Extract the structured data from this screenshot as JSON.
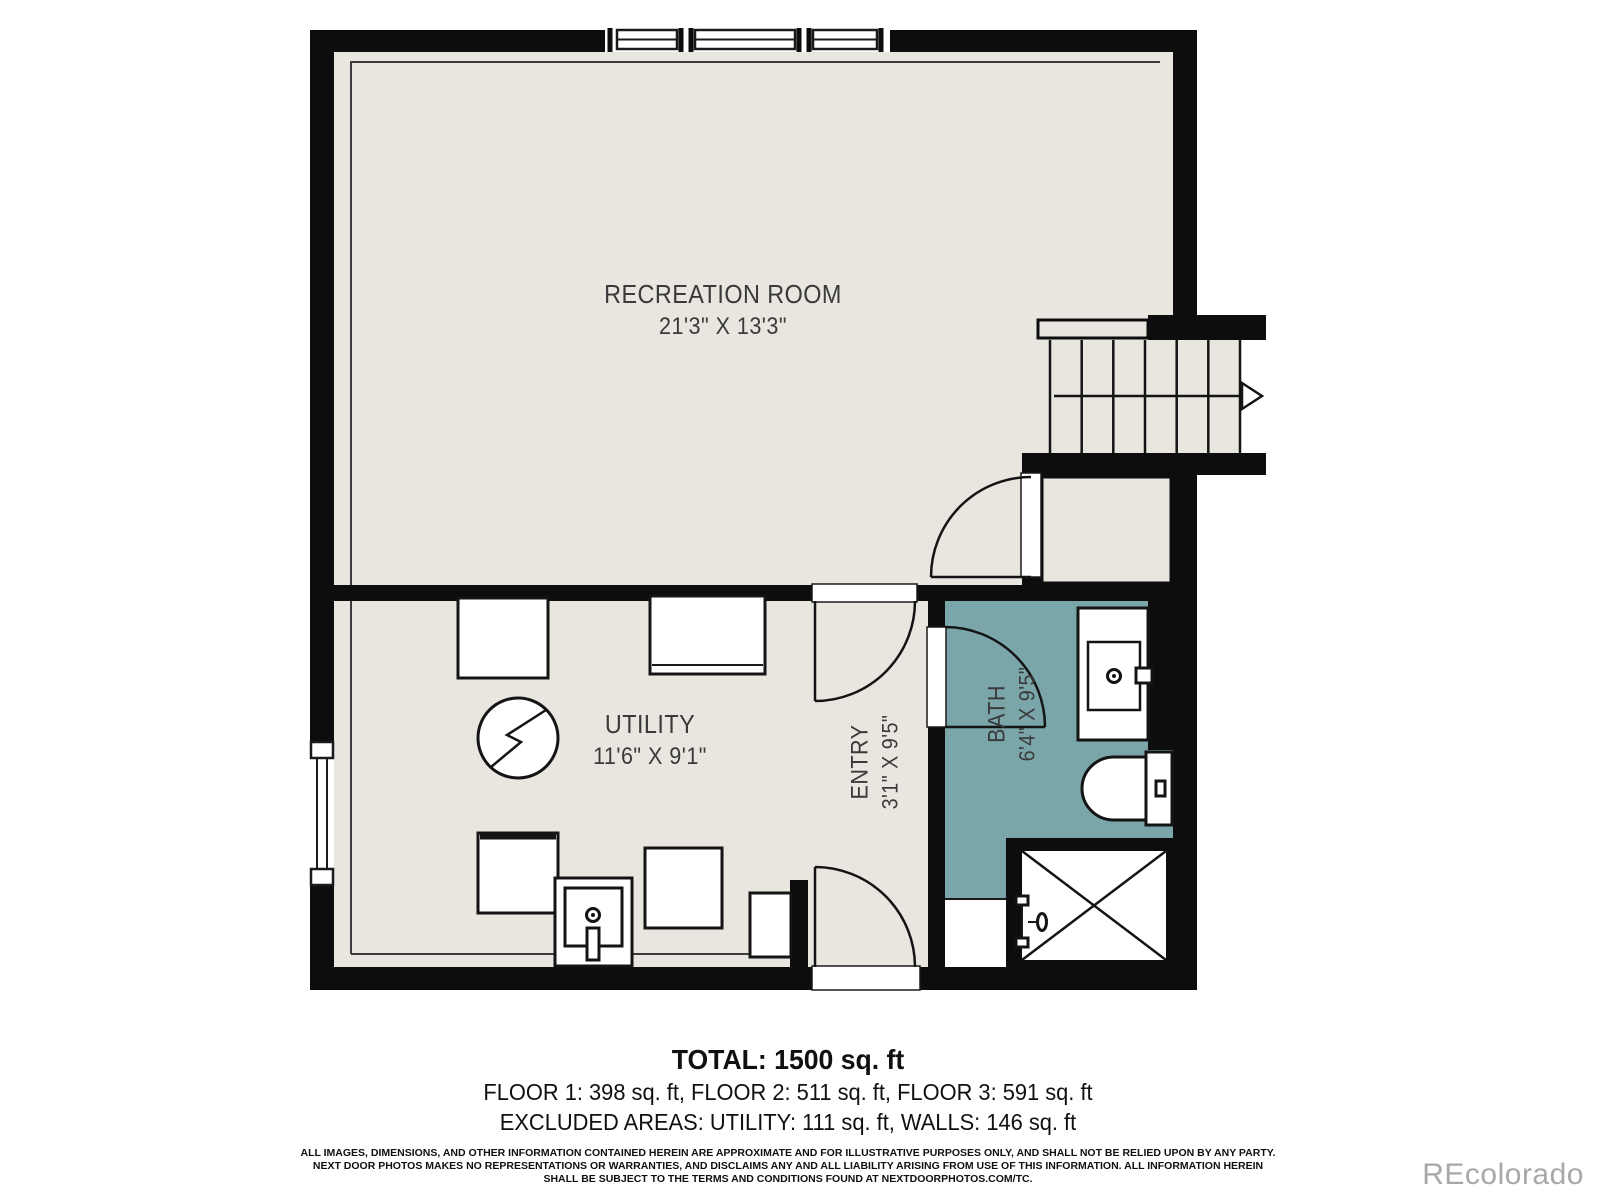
{
  "plan": {
    "rooms": [
      {
        "name": "RECREATION ROOM",
        "dims": "21'3\" X 13'3\""
      },
      {
        "name": "UTILITY",
        "dims": "11'6\" X 9'1\""
      },
      {
        "name": "ENTRY",
        "dims": "3'1\" X 9'5\""
      },
      {
        "name": "BATH",
        "dims": "6'4\" X 9'5\""
      }
    ],
    "icons": [
      "stairs-up-arrow-icon",
      "electrical-bolt-icon",
      "shower-x-icon",
      "toilet-icon",
      "sink-icon",
      "laundry-sink-icon",
      "door-swing-icon",
      "window-icon"
    ]
  },
  "summary": {
    "total": "TOTAL: 1500 sq. ft",
    "floors": "FLOOR 1: 398 sq. ft, FLOOR 2: 511 sq. ft, FLOOR 3: 591 sq. ft",
    "excluded": "EXCLUDED AREAS: UTILITY: 111 sq. ft, WALLS: 146 sq. ft"
  },
  "disclaimer": {
    "text": "ALL IMAGES, DIMENSIONS, AND OTHER INFORMATION CONTAINED HEREIN ARE APPROXIMATE AND FOR ILLUSTRATIVE PURPOSES ONLY, AND SHALL NOT BE RELIED UPON BY ANY PARTY.\nNEXT DOOR PHOTOS MAKES NO REPRESENTATIONS OR WARRANTIES, AND DISCLAIMS ANY AND ALL LIABILITY ARISING FROM USE OF THIS INFORMATION. ALL INFORMATION HEREIN\nSHALL BE SUBJECT TO THE TERMS AND CONDITIONS FOUND AT NEXTDOORPHOTOS.COM/TC."
  },
  "watermark": "REcolorado",
  "colors": {
    "floor": "#e8e6df",
    "wall": "#0d0d0d",
    "bath": "#7aa6aa",
    "line": "#3c3c3c",
    "text": "#3a3a3a",
    "footer_text": "#101010",
    "watermark": "#a8a8a8"
  }
}
